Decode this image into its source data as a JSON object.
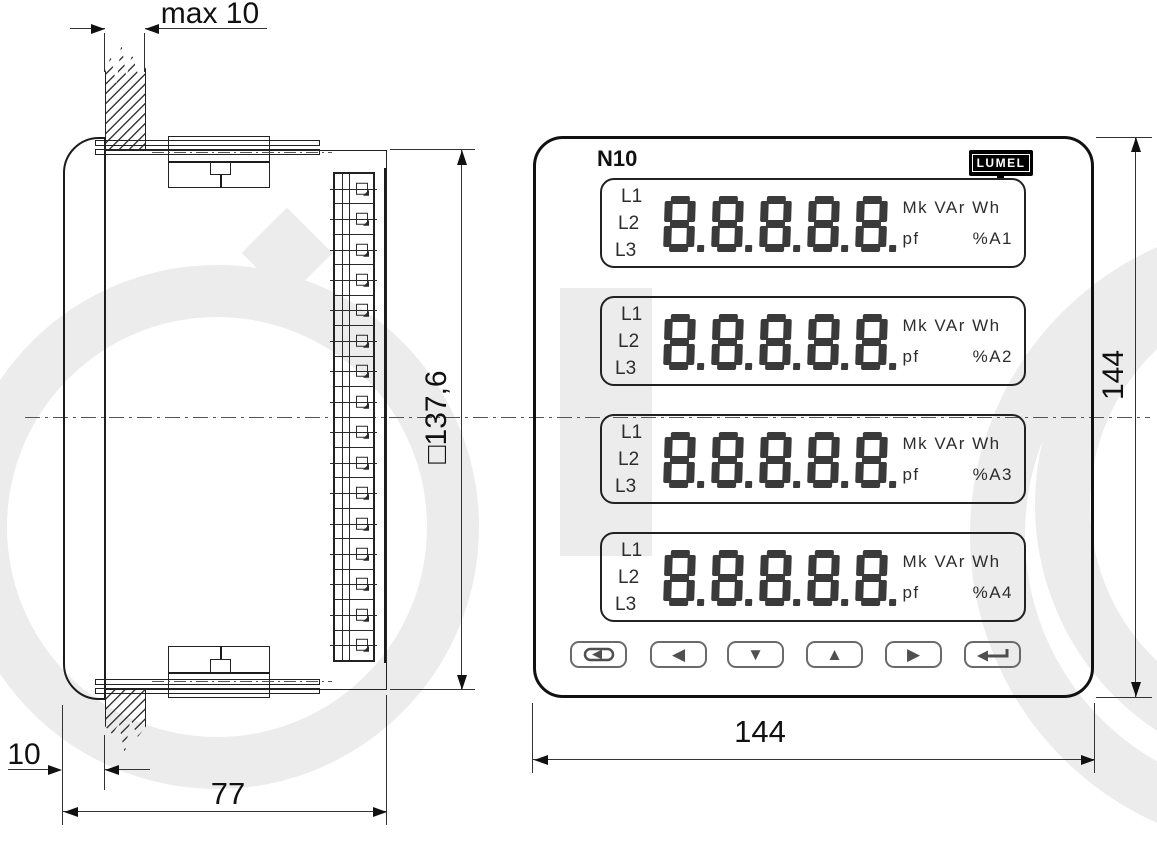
{
  "watermark": {
    "color": "#ececec"
  },
  "side_view": {
    "dim_top": "max 10",
    "dim_panel_thickness": "10",
    "dim_depth": "77",
    "dim_height": "□137,6",
    "terminal_count": 16
  },
  "front_view": {
    "model_label": "N10",
    "brand_logo": "LUMEL",
    "dim_width": "144",
    "dim_height": "144",
    "digit_count": 5,
    "display_rows": [
      {
        "phases": [
          "L1",
          "L2",
          "L3"
        ],
        "units_line1": "Mk VAr Wh",
        "units_pf": "pf",
        "units_channel": "%A1"
      },
      {
        "phases": [
          "L1",
          "L2",
          "L3"
        ],
        "units_line1": "Mk VAr Wh",
        "units_pf": "pf",
        "units_channel": "%A2"
      },
      {
        "phases": [
          "L1",
          "L2",
          "L3"
        ],
        "units_line1": "Mk VAr Wh",
        "units_pf": "pf",
        "units_channel": "%A3"
      },
      {
        "phases": [
          "L1",
          "L2",
          "L3"
        ],
        "units_line1": "Mk VAr Wh",
        "units_pf": "pf",
        "units_channel": "%A4"
      }
    ],
    "buttons": [
      {
        "icon": "cycle-icon"
      },
      {
        "icon": "arrow-left-icon",
        "glyph": "◀"
      },
      {
        "icon": "arrow-down-icon",
        "glyph": "▼"
      },
      {
        "icon": "arrow-up-icon",
        "glyph": "▲"
      },
      {
        "icon": "arrow-right-icon",
        "glyph": "▶"
      },
      {
        "icon": "enter-icon"
      }
    ]
  }
}
